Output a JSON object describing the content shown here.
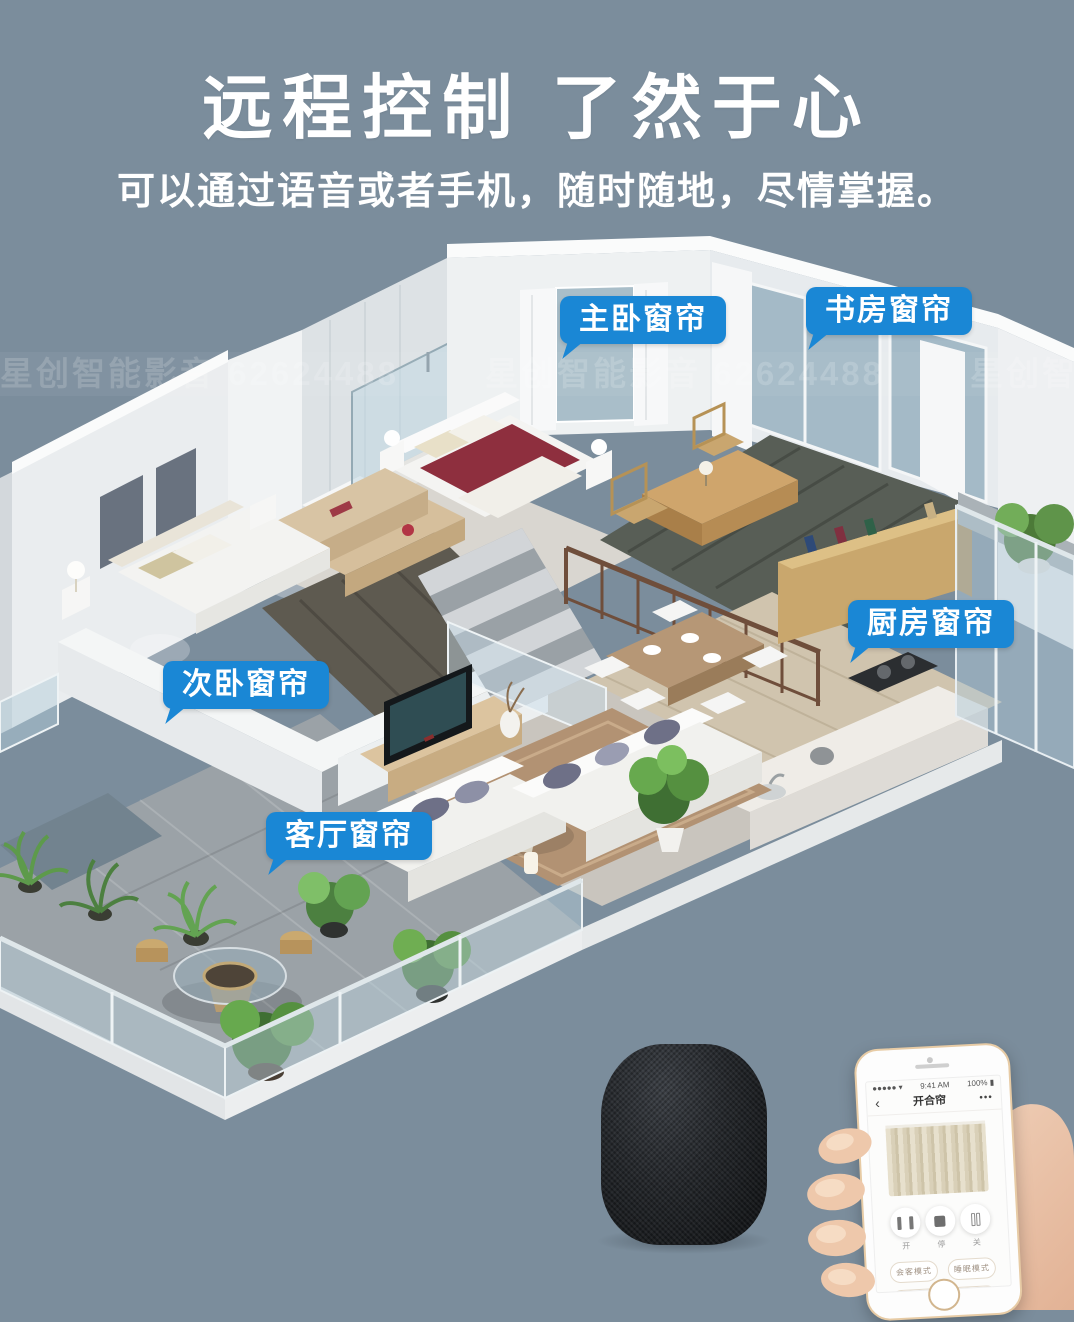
{
  "page": {
    "background_color": "#7b8d9c",
    "accent_blue": "#1a87d5"
  },
  "header": {
    "title": "远程控制 了然于心",
    "subtitle": "可以通过语音或者手机，随时随地，尽情掌握。"
  },
  "watermark": {
    "text": "星创智能影音 62624488"
  },
  "room_labels": [
    {
      "id": "master-bedroom-curtain",
      "text": "主卧窗帘"
    },
    {
      "id": "study-curtain",
      "text": "书房窗帘"
    },
    {
      "id": "kitchen-curtain",
      "text": "厨房窗帘"
    },
    {
      "id": "second-bedroom-curtain",
      "text": "次卧窗帘"
    },
    {
      "id": "living-room-curtain",
      "text": "客厅窗帘"
    }
  ],
  "speaker": {
    "icon": "smart-speaker"
  },
  "phone": {
    "status": {
      "signal_icon": "signal-dots",
      "wifi_icon": "wifi",
      "time": "9:41 AM",
      "battery": "100%",
      "battery_icon": "battery-full"
    },
    "nav": {
      "back": "‹",
      "title": "开合帘",
      "more": "•••"
    },
    "controls": [
      {
        "icon": "curtain-open-icon",
        "label": "开"
      },
      {
        "icon": "stop-icon",
        "label": "停"
      },
      {
        "icon": "curtain-close-icon",
        "label": "关"
      }
    ],
    "modes": [
      {
        "label": "会客模式"
      },
      {
        "label": "睡眠模式"
      },
      {
        "label": "起床模式"
      },
      {
        "label": "遮光模式"
      }
    ]
  }
}
